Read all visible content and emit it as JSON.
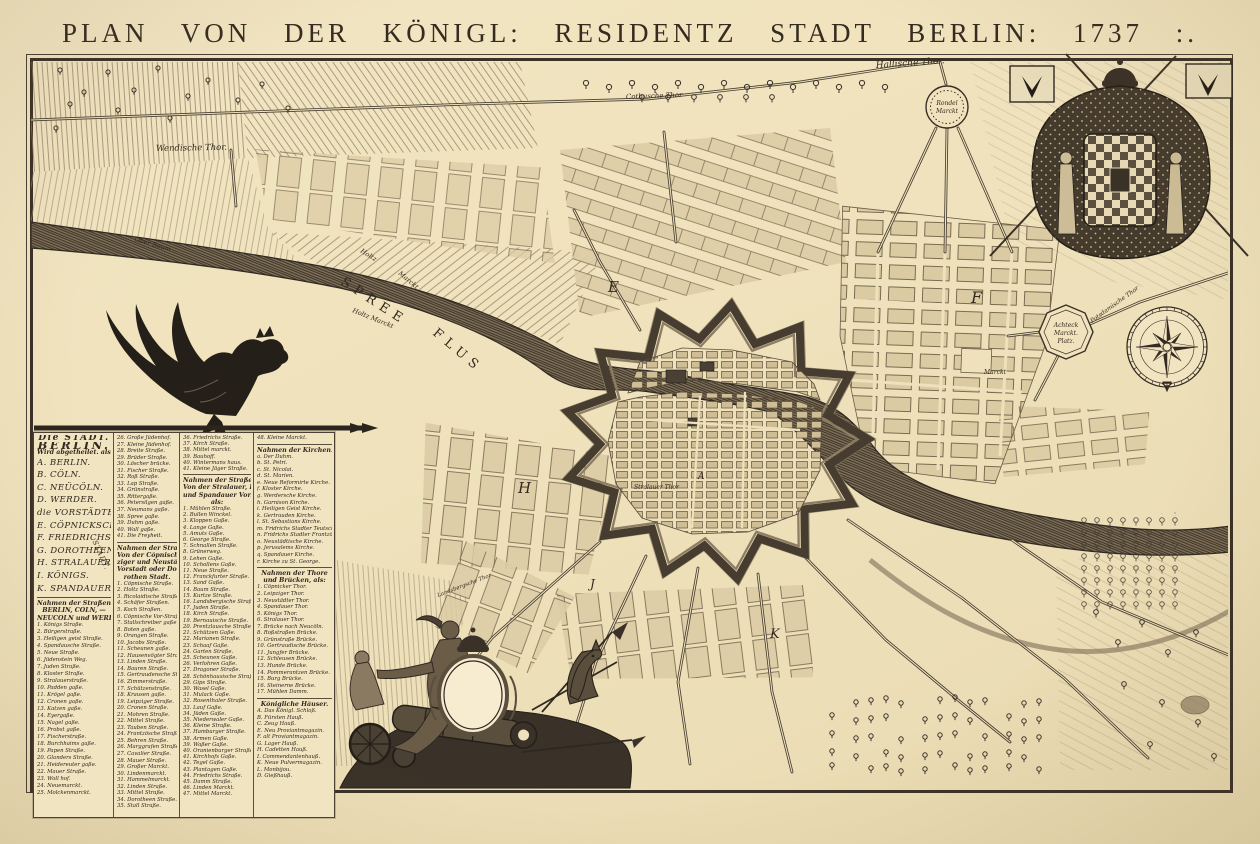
{
  "title": "PLAN   VON   DER   KÖNIGL:   RESIDENTZ   STADT   BERLIN: 1737 :.",
  "palette": {
    "paper": "#f0e2bd",
    "ink": "#3a3127",
    "river": "#7d6e56",
    "block": "#dbcba3"
  },
  "legend": {
    "stadt_note": "STADT.",
    "columns": [
      {
        "sections": [
          {
            "variant": "divisions",
            "header": [
              "Die STADT.",
              "BERLIN.",
              "Wird abgetheilet. als:"
            ],
            "items": [
              "A. BERLIN.",
              "B. CÖLN.",
              "C. NEÜCÖLN.",
              "D. WERDER.",
              "die VORSTÄDTE.",
              "E. CÖPNICKSCHE.",
              "F. FRIEDRICHS",
              "G. DOROTHEEN",
              "H. STRALAUER",
              "I. KÖNIGS.",
              "K. SPANDAUER."
            ]
          },
          {
            "variant": "streets",
            "header": [
              "Nahmen der Straßen Von",
              "BERLIN, CÖLN, —",
              "NEUCÖLN und WERDER."
            ],
            "items": [
              "1. Königs Straße.",
              "2. Bürgerstraße.",
              "3. Heiligen geist Straße.",
              "4. Spandausche Straße.",
              "5. Neue Straße.",
              "6. Jüdenstein Weg.",
              "7. Juden Straße.",
              "8. Kloster Straße.",
              "9. Stralauerstraße.",
              "10. Padden gaße.",
              "11. Krögel gaße.",
              "12. Cronen gaße.",
              "13. Katzen gaße.",
              "14. Eyergaße.",
              "15. Nagel gaße.",
              "16. Probst gaße.",
              "17. Fischerstraße.",
              "18. Burchhaims gaße.",
              "19. Papen Straße.",
              "20. Glanders Straße.",
              "21. Heidereuter gaße.",
              "22. Mauer Straße.",
              "23. Woll hof.",
              "24. Neuemarckt.",
              "25. Molckenmarckt."
            ]
          }
        ]
      },
      {
        "sections": [
          {
            "variant": "streets",
            "items": [
              "26. Große Jüdenhof.",
              "27. Kleine Jüdenhof.",
              "28. Breite Straße.",
              "29. Brüder Straße.",
              "30. Löscher brücke.",
              "31. Fischer Straße.",
              "32. Roß Straße.",
              "33. Lap Straße.",
              "34. Grünstraße.",
              "35. Rittergaße.",
              "36. Petersilgen gaße.",
              "37. Neumans gaße.",
              "38. Spree gaße.",
              "39. Duhm gaße.",
              "40. Wall gaße.",
              "41. Die Freyheit."
            ]
          },
          {
            "variant": "streets",
            "header": [
              "Nahmen der Straßen,",
              "Von der Cöpnischer Leip-",
              "ziger und Neustädter",
              "Vorstadt oder Do-",
              "rothen Stadt."
            ],
            "items": [
              "1. Cöpnische Straße.",
              "2. Holtz Straße.",
              "3. Ricolaidische Straße.",
              "4. Schäfer Straßen.",
              "5. Koch Straßen.",
              "6. Cöpnische Vor-Straße.",
              "7. Stallschreiber gaße.",
              "8. Boten gaße.",
              "9. Orangen Straße.",
              "10. Jacobs Straße.",
              "11. Scheunen gaße.",
              "12. Hausenvögter Straße.",
              "13. Linden Straße.",
              "14. Bauren Straße.",
              "15. Gertraudensche Straße.",
              "16. Zimmerstraße.",
              "17. Schützenstraße.",
              "18. Krausen gaße.",
              "19. Leipziger Straße.",
              "20. Cronen Straße.",
              "21. Mohren Straße.",
              "22. Mittel Straße.",
              "23. Tauben Straße.",
              "24. Frantzösche Straße.",
              "25. Behren Straße.",
              "26. Marggrafen Straße.",
              "27. Cavalier Straße.",
              "28. Mauer Straße.",
              "29. Großer Marckt.",
              "30. Lindenmarckt.",
              "31. Hammelmarckt.",
              "32. Linden Straße.",
              "33. Mittel Straße.",
              "34. Dorotheen Straße.",
              "35. Stall Straße."
            ]
          }
        ]
      },
      {
        "sections": [
          {
            "variant": "streets",
            "items": [
              "36. Friedrichs Straße.",
              "37. Kirch Straße.",
              "38. Mittel marckt.",
              "39. Bauhoff.",
              "40. Wintermans haus.",
              "41. Kleine Jäger Straße."
            ]
          },
          {
            "variant": "streets",
            "header": [
              "Nahmen der Straßen,",
              "Von der Stralauer, Königs",
              "und Spandauer Vorstädte",
              "als:"
            ],
            "items": [
              "1. Mühlen Straße.",
              "2. Bullen Winckel.",
              "3. Kloppen Gaße.",
              "4. Lange Gaße.",
              "5. Amuts Gaße.",
              "6. George Straße.",
              "7. Schnallen Straße.",
              "8. Grünerweg.",
              "9. Lehen Gaße.",
              "10. Schollens Gaße.",
              "11. Neue Straße.",
              "12. Franckfurter Straße.",
              "13. Sand Gaße.",
              "14. Baum Straße.",
              "15. Kurtze Straße.",
              "16. Landsbergische Straße.",
              "17. Juden Straße.",
              "18. Kirch Straße.",
              "19. Bernauische Straße.",
              "20. Prentzlausche Straße.",
              "21. Schützen Gaße.",
              "22. Marianen Straße.",
              "23. Schaaf Gaße.",
              "24. Garten Straße.",
              "25. Scheunen Gaße.",
              "26. Verlohren Gaße.",
              "27. Dragoner Straße.",
              "28. Schönhausische Straße.",
              "29. Gips Straße.",
              "30. Wasel Gaße.",
              "31. Mulack Gaße.",
              "32. Rosenthaler Straße.",
              "33. Lauf Gaße.",
              "34. Jüden Gaße.",
              "35. Niederwaler Gaße.",
              "36. Kleine Straße.",
              "37. Hamburger Straße.",
              "38. Armen Gaße.",
              "39. Waßer Gaße.",
              "40. Oranienburger Straße.",
              "41. Kirchhofs Gaße.",
              "42. Tegel Gaße.",
              "43. Plantagen Gaße.",
              "44. Friedrichs Straße.",
              "45. Damm Straße.",
              "46. Linden Marckt.",
              "47. Mittel Marckt."
            ]
          }
        ]
      },
      {
        "sections": [
          {
            "variant": "streets",
            "items": [
              "48. Kleine Marckt."
            ]
          },
          {
            "variant": "streets",
            "header": [
              "Nahmen der Kirchen."
            ],
            "items": [
              "a. Der Duhm.",
              "b. St. Petri.",
              "c. St. Nicolai.",
              "d. St. Marien.",
              "e. Neue Reformirte Kirche.",
              "f. Kloster Kirche.",
              "g. Werdersche Kirche.",
              "h. Garnison Kirche.",
              "i. Heiligen Geist Kirche.",
              "k. Gertrauden Kirche.",
              "l. St. Sebastians Kirche.",
              "m. Fridrichs Stadter Teutsche Kirche.",
              "n. Fridrichs Stadter Frantzösische Kirche.",
              "o. Neustädtische Kirche.",
              "p. Jerusalems Kirche.",
              "q. Spandauer Kirche.",
              "r. Kirche zu St. George."
            ]
          },
          {
            "variant": "streets",
            "header": [
              "Nahmen der Thore",
              "und Brücken, als:"
            ],
            "items": [
              "1. Cöpnicker Thor.",
              "2. Leipziger Thor.",
              "3. Neustädter Thor.",
              "4. Spandauer Thor.",
              "5. Königs Thor.",
              "6. Stralauer Thor.",
              "7. Brücke nach Neucöln.",
              "8. Roßstraßen Brücke.",
              "9. Grünstraße Brücke.",
              "10. Gertraudische Brücke.",
              "11. Jungfer Brücke.",
              "12. Schleusen Brücke.",
              "13. Hunde Brücke.",
              "14. Pommerantzen Brücke.",
              "15. Burg Brücke.",
              "16. Steinerne Brücke.",
              "17. Mühlen Damm."
            ]
          },
          {
            "variant": "streets",
            "header": [
              "Königliche Häuser."
            ],
            "items": [
              "A. Das Königl. Schloß.",
              "B. Fürsten Hauß.",
              "C. Zeug Hauß.",
              "E. Neu Proviantmagazin.",
              "F. alt Proviantmagazin.",
              "G. Lager Hauß.",
              "H. Cadetten Hauß.",
              "I. Commendantenhauß.",
              "K. Neue Pulvermagazin.",
              "L. Monbijou.",
              "D. Gießhauß."
            ]
          }
        ]
      }
    ]
  },
  "map": {
    "labels": [
      {
        "t": "Hallische Thor.",
        "x": 876,
        "y": 68,
        "s": 9,
        "r": -4,
        "i": 1
      },
      {
        "t": "Cotbusche Thor",
        "x": 626,
        "y": 99,
        "s": 7,
        "r": -2,
        "i": 1
      },
      {
        "t": "Wendische Thor.",
        "x": 156,
        "y": 151,
        "s": 8.5,
        "r": -1,
        "i": 1
      },
      {
        "t": "Ober Baum",
        "x": 134,
        "y": 241,
        "s": 6.5,
        "r": 16,
        "i": 1
      },
      {
        "t": "Holtz",
        "x": 360,
        "y": 252,
        "s": 6.5,
        "r": 32,
        "i": 1
      },
      {
        "t": "Marckt",
        "x": 398,
        "y": 274,
        "s": 6.5,
        "r": 40,
        "i": 1
      },
      {
        "t": "Holtz Marckt",
        "x": 352,
        "y": 312,
        "s": 6.5,
        "r": 22,
        "i": 1
      },
      {
        "t": "SPREE",
        "x": 340,
        "y": 284,
        "s": 13,
        "r": 33,
        "ls": 6
      },
      {
        "t": "FLUS",
        "x": 432,
        "y": 334,
        "s": 13,
        "r": 40,
        "ls": 6
      },
      {
        "t": "Rondel",
        "x": 947,
        "y": 105,
        "s": 6,
        "a": "m",
        "i": 1
      },
      {
        "t": "Marckt",
        "x": 947,
        "y": 113,
        "s": 6,
        "a": "m",
        "i": 1
      },
      {
        "t": "Achteck",
        "x": 1066,
        "y": 327,
        "s": 6,
        "a": "m",
        "i": 1
      },
      {
        "t": "Marckt.",
        "x": 1066,
        "y": 335,
        "s": 6,
        "a": "m",
        "i": 1
      },
      {
        "t": "Platz.",
        "x": 1066,
        "y": 343,
        "s": 6,
        "a": "m",
        "i": 1
      },
      {
        "t": "Potsdamische Thor",
        "x": 1092,
        "y": 323,
        "s": 6,
        "r": -36,
        "i": 1
      },
      {
        "t": "Marckt",
        "x": 984,
        "y": 374,
        "s": 6,
        "i": 1
      },
      {
        "t": "Stralauer Thor",
        "x": 634,
        "y": 489,
        "s": 6,
        "i": 1
      },
      {
        "t": "Landsbergsche Thor",
        "x": 438,
        "y": 597,
        "s": 5.5,
        "r": -21,
        "i": 1
      },
      {
        "t": "E",
        "x": 608,
        "y": 292,
        "s": 15,
        "i": 1
      },
      {
        "t": "F",
        "x": 971,
        "y": 303,
        "s": 16,
        "i": 1
      },
      {
        "t": "H",
        "x": 518,
        "y": 493,
        "s": 15,
        "i": 1
      },
      {
        "t": "K",
        "x": 770,
        "y": 638,
        "s": 13,
        "i": 1
      },
      {
        "t": "J",
        "x": 590,
        "y": 588,
        "s": 12,
        "i": 1
      },
      {
        "t": "A",
        "x": 698,
        "y": 479,
        "s": 9,
        "i": 1
      }
    ]
  }
}
